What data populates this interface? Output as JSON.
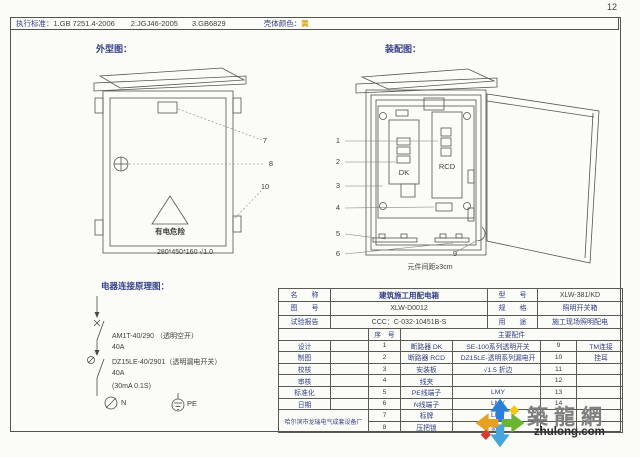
{
  "page": {
    "number": "12"
  },
  "header": {
    "standards_label": "执行标准：",
    "standard1": "1.GB 7251.4-2006",
    "standard2": "2.JGJ46-2005",
    "standard3": "3.GB6829",
    "shell_color_label": "壳体颜色：",
    "shell_color_value": "黄"
  },
  "outline": {
    "title": "外型图：",
    "warning": "有电危险",
    "dimension": "280*450*160  √1.0",
    "callout7": "7",
    "callout8": "8",
    "callout10": "10"
  },
  "assembly": {
    "title": "装配图：",
    "dk": "DK",
    "rcd": "RCD",
    "spacing_note": "元件间距≥3cm",
    "callout1": "1",
    "callout2": "2",
    "callout3": "3",
    "callout4": "4",
    "callout5": "5",
    "callout6": "6",
    "callout9": "9"
  },
  "schematic": {
    "title": "电器连接原理图：",
    "lines": [
      "AM1T-40/290 （透明空开）",
      "40A",
      "DZ15LE-40/2901（透明漏电开关）",
      "40A",
      "(30mA 0.1S)"
    ],
    "n_label": "N",
    "pe_label": "PE"
  },
  "info": {
    "name_label": "名　　称",
    "name_value": "建筑施工用配电箱",
    "model_label": "型　　号",
    "model_value": "XLW-381/KD",
    "drawing_label": "图　　号",
    "drawing_value": "XLW-D0012",
    "spec_label": "规　　格",
    "spec_value": "照明开关箱",
    "report_label": "试验报告",
    "report_value": "CCC：C-032-10451B-S",
    "use_label": "用　　途",
    "use_value": "施工现场照明配电",
    "seq_label": "序　号",
    "parts_label": "主要配件"
  },
  "titleblock": {
    "fields": [
      "设计",
      "制图",
      "校核",
      "审核",
      "标准化",
      "日期"
    ],
    "factory": "哈尔滨市龙瑞电气成套设备厂"
  },
  "parts": [
    {
      "no": "1",
      "name": "断路器 DK",
      "spec": "SE-100系列透明开关",
      "no2": "9",
      "name2": "TM连接"
    },
    {
      "no": "2",
      "name": "断路器 RCD",
      "spec": "DZ15LE-透明系列漏电开",
      "no2": "10",
      "name2": "挂耳"
    },
    {
      "no": "3",
      "name": "安装板",
      "spec": "√1.5 折边",
      "no2": "11",
      "name2": ""
    },
    {
      "no": "4",
      "name": "线夹",
      "spec": "",
      "no2": "12",
      "name2": ""
    },
    {
      "no": "5",
      "name": "PE线端子",
      "spec": "LMY",
      "no2": "13",
      "name2": ""
    },
    {
      "no": "6",
      "name": "N线端子",
      "spec": "LMY",
      "no2": "14",
      "name2": ""
    },
    {
      "no": "7",
      "name": "标牌",
      "spec": "LMY",
      "no2": "",
      "name2": ""
    },
    {
      "no": "8",
      "name": "压把锁",
      "spec": "防雨",
      "no2": "",
      "name2": ""
    }
  ],
  "watermark": {
    "cn": "築龍網",
    "url": "zhulong.com"
  }
}
